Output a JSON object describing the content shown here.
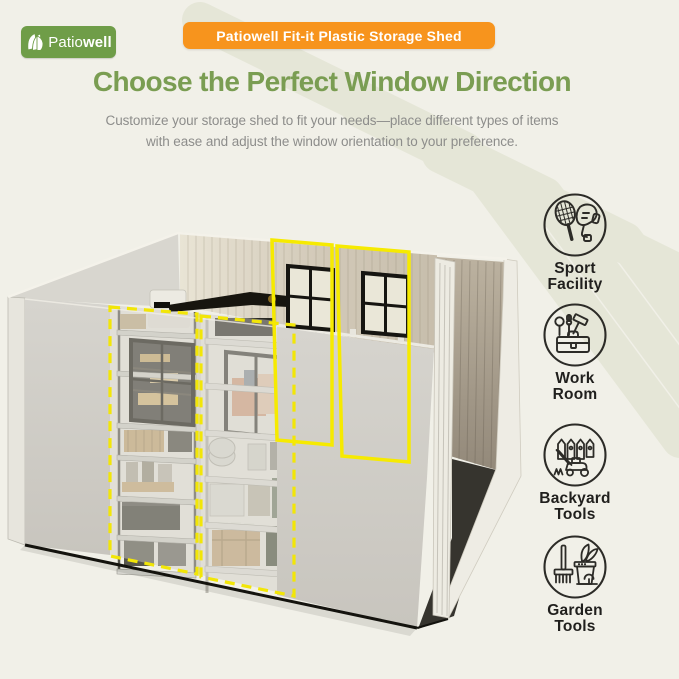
{
  "page": {
    "background": "#f1f0e8",
    "watermark_color": "#e5e6d7"
  },
  "logo": {
    "text_regular": "Patio",
    "text_bold": "well",
    "bg_color": "#6f9d48"
  },
  "banner": {
    "label": "Patiowell Fit-it Plastic Storage Shed",
    "bg_color": "#f7941d"
  },
  "heading": {
    "title": "Choose the Perfect Window Direction",
    "color": "#7a9d52"
  },
  "subtitle": {
    "line1": "Customize your storage shed to fit your needs—place different types of items",
    "line2": "with ease and adjust the window orientation to your preference."
  },
  "use_cases": [
    {
      "id": "sport-facility",
      "line1": "Sport",
      "line2": "Facility",
      "icon": "tennis-racket-glove-icon"
    },
    {
      "id": "work-room",
      "line1": "Work",
      "line2": "Room",
      "icon": "toolbox-icon"
    },
    {
      "id": "backyard-tools",
      "line1": "Backyard",
      "line2": "Tools",
      "icon": "fence-lawnmower-icon"
    },
    {
      "id": "garden-tools",
      "line1": "Garden",
      "line2": "Tools",
      "icon": "rake-plant-pot-icon"
    }
  ],
  "illustration": {
    "description": "Isometric storage shed interior with shelving units, two installed rear windows and highlighted alternative window panel positions",
    "highlight_color": "#f6e800",
    "solid_window_outlines": 2,
    "dashed_window_outlines": 2
  }
}
